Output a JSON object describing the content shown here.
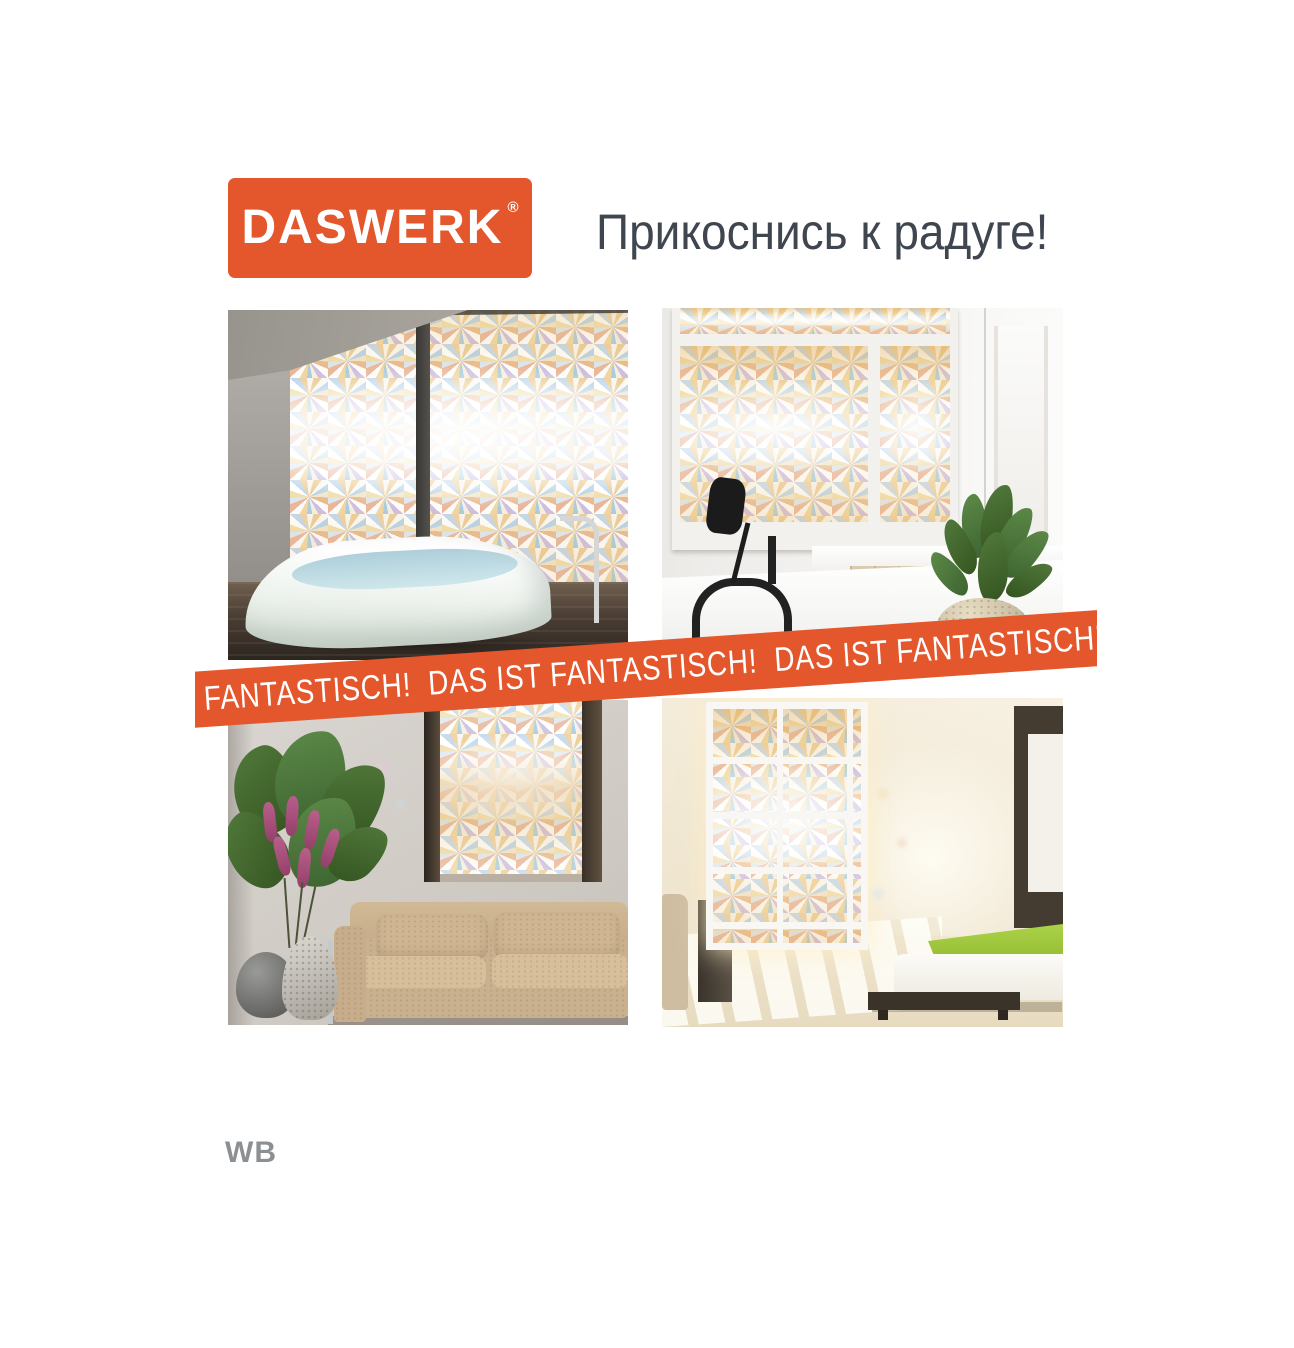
{
  "colors": {
    "accent": "#e4562b",
    "tagline": "#3f4650",
    "watermark": "#8d9093"
  },
  "brand": {
    "name": "DASWERK",
    "reg_mark": "®"
  },
  "header": {
    "tagline": "Прикоснись к радуге!"
  },
  "ribbon": {
    "text": "FANTASTISCH!  DAS IST FANTASTISCH!  DAS IST FANTASTISCH!    DAS IST"
  },
  "footer": {
    "watermark": "WB"
  },
  "photos": [
    {
      "name": "bathroom-freestanding-tub-rainbow-film"
    },
    {
      "name": "bathroom-vanity-black-faucet-plant"
    },
    {
      "name": "living-room-beige-sofa-plant"
    },
    {
      "name": "bedroom-grid-window-green-bed"
    }
  ]
}
